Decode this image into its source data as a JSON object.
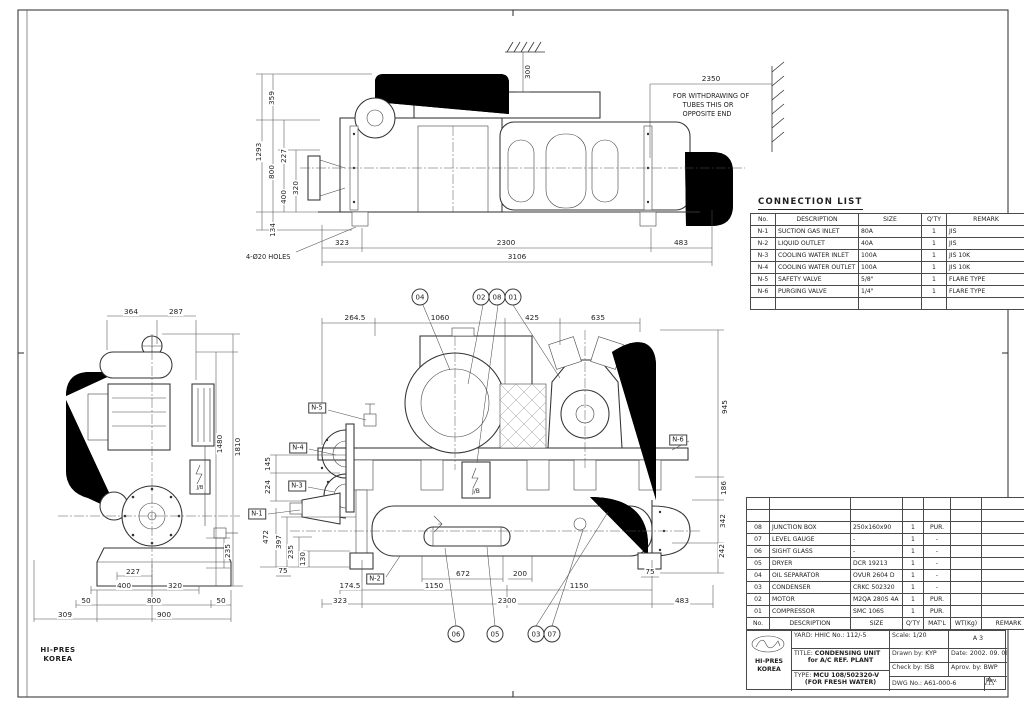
{
  "connection_list": {
    "title": "CONNECTION LIST",
    "headers": [
      "No.",
      "DESCRIPTION",
      "SIZE",
      "Q'TY",
      "REMARK"
    ],
    "rows": [
      [
        "N-1",
        "SUCTION GAS INLET",
        "80A",
        "1",
        "JIS"
      ],
      [
        "N-2",
        "LIQUID OUTLET",
        "40A",
        "1",
        "JIS"
      ],
      [
        "N-3",
        "COOLING WATER INLET",
        "100A",
        "1",
        "JIS 10K"
      ],
      [
        "N-4",
        "COOLING WATER OUTLET",
        "100A",
        "1",
        "JIS 10K"
      ],
      [
        "N-5",
        "SAFETY VALVE",
        "5/8\"",
        "1",
        "FLARE TYPE"
      ],
      [
        "N-6",
        "PURGING VALVE",
        "1/4\"",
        "1",
        "FLARE TYPE"
      ],
      [
        "",
        "",
        "",
        "",
        ""
      ]
    ]
  },
  "parts_list": {
    "headers": [
      "No.",
      "DESCRIPTION",
      "SIZE",
      "Q'TY",
      "MAT'L",
      "WT(Kg)",
      "REMARK"
    ],
    "rows": [
      [
        "",
        "",
        "",
        "",
        "",
        "",
        ""
      ],
      [
        "",
        "",
        "",
        "",
        "",
        "",
        ""
      ],
      [
        "08",
        "JUNCTION BOX",
        "250x160x90",
        "1",
        "PUR.",
        "",
        ""
      ],
      [
        "07",
        "LEVEL GAUGE",
        "-",
        "1",
        "-",
        "",
        ""
      ],
      [
        "06",
        "SIGHT GLASS",
        "-",
        "1",
        "-",
        "",
        ""
      ],
      [
        "05",
        "DRYER",
        "DCR 19213",
        "1",
        "-",
        "",
        ""
      ],
      [
        "04",
        "OIL SEPARATOR",
        "OVUR 2604 D",
        "1",
        "-",
        "",
        ""
      ],
      [
        "03",
        "CONDENSER",
        "CRKC 502320",
        "1",
        "-",
        "",
        ""
      ],
      [
        "02",
        "MOTOR",
        "M2QA 280S 4A",
        "1",
        "PUR.",
        "",
        ""
      ],
      [
        "01",
        "COMPRESSOR",
        "SMC 106S",
        "1",
        "PUR.",
        "",
        ""
      ]
    ]
  },
  "title_block": {
    "yard_label": "YARD:",
    "yard": "HHIC No.: 112/-5",
    "scale_label": "Scale:",
    "scale": "1/20",
    "size": "A 3",
    "title_label": "TITLE:",
    "title1": "CONDENSING UNIT",
    "title2": "for A/C REF. PLANT",
    "drawn_label": "Drawn by:",
    "drawn": "KYP",
    "date_label": "Date:",
    "date": "2002. 09. 09",
    "check_label": "Check by:",
    "check": "ISB",
    "approve_label": "Aprov. by:",
    "approve": "BWP",
    "type_label": "TYPE:",
    "type1": "MCU 108/502320-V",
    "type2": "(FOR FRESH WATER)",
    "dwg_label": "DWG No.:",
    "dwg_no": "A61-000-6",
    "rev_label": "Rev."
  },
  "company": {
    "name1": "HI-PRES",
    "name2": "KOREA"
  },
  "notes": {
    "withdraw1": "FOR WITHDRAWING OF",
    "withdraw2": "TUBES THIS OR",
    "withdraw3": "OPPOSITE END",
    "holes": "4-Ø20 HOLES",
    "jb_front": "J/B",
    "jb_side": "J/B"
  },
  "dimension_labels": [
    {
      "t": "1293",
      "x": 259,
      "y": 152,
      "r": -90
    },
    {
      "t": "359",
      "x": 272,
      "y": 98,
      "r": -90
    },
    {
      "t": "800",
      "x": 272,
      "y": 172,
      "r": -90
    },
    {
      "t": "227",
      "x": 284,
      "y": 156,
      "r": -90
    },
    {
      "t": "400",
      "x": 284,
      "y": 197,
      "r": -90
    },
    {
      "t": "320",
      "x": 296,
      "y": 188,
      "r": -90
    },
    {
      "t": "134",
      "x": 273,
      "y": 230,
      "r": -90
    },
    {
      "t": "300",
      "x": 528,
      "y": 72,
      "r": -90
    },
    {
      "t": "2350",
      "x": 711,
      "y": 79
    },
    {
      "t": "323",
      "x": 342,
      "y": 243
    },
    {
      "t": "2300",
      "x": 506,
      "y": 243
    },
    {
      "t": "483",
      "x": 681,
      "y": 243
    },
    {
      "t": "3106",
      "x": 517,
      "y": 257
    },
    {
      "t": "264.5",
      "x": 355,
      "y": 318
    },
    {
      "t": "1060",
      "x": 440,
      "y": 318
    },
    {
      "t": "425",
      "x": 532,
      "y": 318
    },
    {
      "t": "635",
      "x": 598,
      "y": 318
    },
    {
      "t": "945",
      "x": 725,
      "y": 407,
      "r": -90
    },
    {
      "t": "186",
      "x": 724,
      "y": 488,
      "r": -90
    },
    {
      "t": "342",
      "x": 723,
      "y": 521,
      "r": -90
    },
    {
      "t": "242",
      "x": 722,
      "y": 551,
      "r": -90
    },
    {
      "t": "75",
      "x": 650,
      "y": 572
    },
    {
      "t": "145",
      "x": 268,
      "y": 464,
      "r": -90
    },
    {
      "t": "224",
      "x": 268,
      "y": 487,
      "r": -90
    },
    {
      "t": "472",
      "x": 266,
      "y": 537,
      "r": -90
    },
    {
      "t": "397",
      "x": 279,
      "y": 542,
      "r": -90
    },
    {
      "t": "235",
      "x": 291,
      "y": 552,
      "r": -90
    },
    {
      "t": "130",
      "x": 303,
      "y": 559,
      "r": -90
    },
    {
      "t": "75",
      "x": 283,
      "y": 571
    },
    {
      "t": "672",
      "x": 463,
      "y": 574
    },
    {
      "t": "200",
      "x": 520,
      "y": 574
    },
    {
      "t": "174.5",
      "x": 350,
      "y": 586
    },
    {
      "t": "1150",
      "x": 434,
      "y": 586
    },
    {
      "t": "1150",
      "x": 579,
      "y": 586
    },
    {
      "t": "323",
      "x": 340,
      "y": 601
    },
    {
      "t": "2300",
      "x": 507,
      "y": 601
    },
    {
      "t": "483",
      "x": 682,
      "y": 601
    },
    {
      "t": "364",
      "x": 131,
      "y": 312
    },
    {
      "t": "287",
      "x": 176,
      "y": 312
    },
    {
      "t": "1480",
      "x": 220,
      "y": 444,
      "r": -90
    },
    {
      "t": "1810",
      "x": 238,
      "y": 447,
      "r": -90
    },
    {
      "t": "235",
      "x": 228,
      "y": 551,
      "r": -90
    },
    {
      "t": "227",
      "x": 133,
      "y": 572
    },
    {
      "t": "400",
      "x": 124,
      "y": 586
    },
    {
      "t": "320",
      "x": 175,
      "y": 586
    },
    {
      "t": "50",
      "x": 86,
      "y": 601
    },
    {
      "t": "800",
      "x": 154,
      "y": 601
    },
    {
      "t": "50",
      "x": 221,
      "y": 601
    },
    {
      "t": "309",
      "x": 65,
      "y": 615
    },
    {
      "t": "900",
      "x": 164,
      "y": 615
    }
  ],
  "connection_tags": [
    {
      "t": "N-5",
      "x": 317,
      "y": 408
    },
    {
      "t": "N-4",
      "x": 298,
      "y": 448
    },
    {
      "t": "N-3",
      "x": 297,
      "y": 486
    },
    {
      "t": "N-1",
      "x": 257,
      "y": 514
    },
    {
      "t": "N-2",
      "x": 375,
      "y": 579
    },
    {
      "t": "N-6",
      "x": 678,
      "y": 440
    }
  ],
  "balloons": [
    {
      "t": "04",
      "x": 420,
      "y": 297
    },
    {
      "t": "02",
      "x": 481,
      "y": 297
    },
    {
      "t": "08",
      "x": 497,
      "y": 297
    },
    {
      "t": "01",
      "x": 513,
      "y": 297
    },
    {
      "t": "06",
      "x": 456,
      "y": 634
    },
    {
      "t": "05",
      "x": 495,
      "y": 634
    },
    {
      "t": "03",
      "x": 536,
      "y": 634
    },
    {
      "t": "07",
      "x": 552,
      "y": 634
    }
  ]
}
